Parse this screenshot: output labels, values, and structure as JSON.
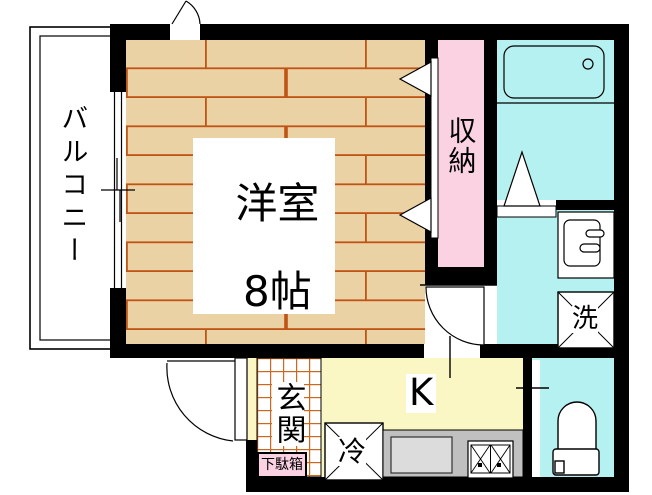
{
  "labels": {
    "balcony": "バルコニー",
    "room_name": "洋室",
    "room_size": "8帖",
    "closet": "収納",
    "washer": "洗",
    "kitchen": "K",
    "fridge": "冷",
    "entrance": "玄関",
    "shoe_cabinet": "下駄箱"
  },
  "colors": {
    "wall": "#000000",
    "wood_floor": "#ebd2a4",
    "wood_line": "#c05415",
    "closet_pink": "#fad2e2",
    "water_cyan": "#b5f1f1",
    "kitchen_yellow": "#faf7c5",
    "counter_gray": "#c0c0c0",
    "sink_gray": "#dcdcdc",
    "tile_line": "#cc6820",
    "shoe_cabinet_pink": "#fad2e2"
  }
}
